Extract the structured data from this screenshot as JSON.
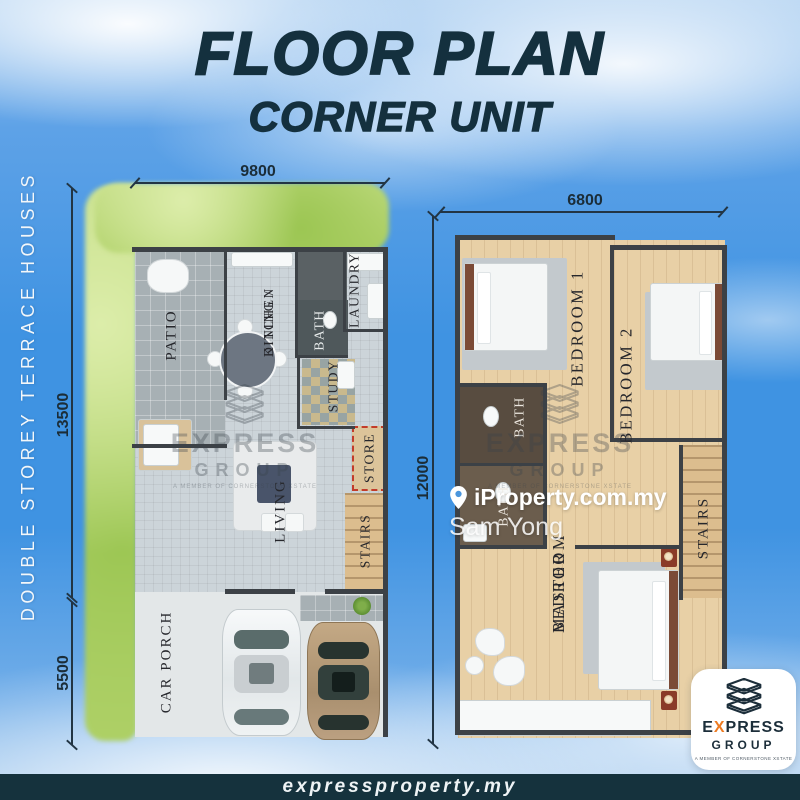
{
  "title": {
    "main": "FLOOR PLAN",
    "sub": "CORNER UNIT"
  },
  "side_label": "DOUBLE STOREY TERRACE HOUSES",
  "ground_floor": {
    "dim_top": "9800",
    "dim_left_upper": "13500",
    "dim_left_lower": "5500",
    "rooms": {
      "patio": "PATIO",
      "dining_line1": "DINING /",
      "dining_line2": "KITCHEN",
      "bath": "BATH",
      "laundry": "LAUNDRY",
      "study": "STUDY",
      "store": "STORE",
      "stairs": "STAIRS",
      "living": "LIVING",
      "car_porch": "CAR PORCH"
    }
  },
  "first_floor": {
    "dim_top": "6800",
    "dim_left": "12000",
    "rooms": {
      "bedroom1": "BEDROOM 1",
      "bedroom2": "BEDROOM 2",
      "bath_upper": "BATH",
      "bath_lower": "BATH",
      "stairs": "STAIRS",
      "master_line1": "MASTER",
      "master_line2": "BEDROOM"
    }
  },
  "watermark": {
    "brand_line1": "EXPRESS",
    "brand_line2": "GROUP",
    "tagline": "A MEMBER OF CORNERSTONE XSTATE"
  },
  "agent": {
    "portal": "iProperty.com.my",
    "name": "Sam Yong"
  },
  "badge": {
    "brand_e": "E",
    "brand_x": "X",
    "brand_press": "PRESS",
    "brand_line2": "GROUP",
    "tagline": "A MEMBER OF CORNERSTONE XSTATE"
  },
  "footer": {
    "website": "expressproperty.my"
  },
  "colors": {
    "title_navy": "#14303e",
    "footer_bar": "#15323d",
    "accent_orange": "#ee7b22",
    "sky_blue": "#3f93e2",
    "grass_green": "#b8d978",
    "wall": "#3c4146",
    "wood_floor": "#e8d0a6",
    "tile_gray": "#a7b0b4",
    "store_dashed_red": "#c23b2a"
  }
}
